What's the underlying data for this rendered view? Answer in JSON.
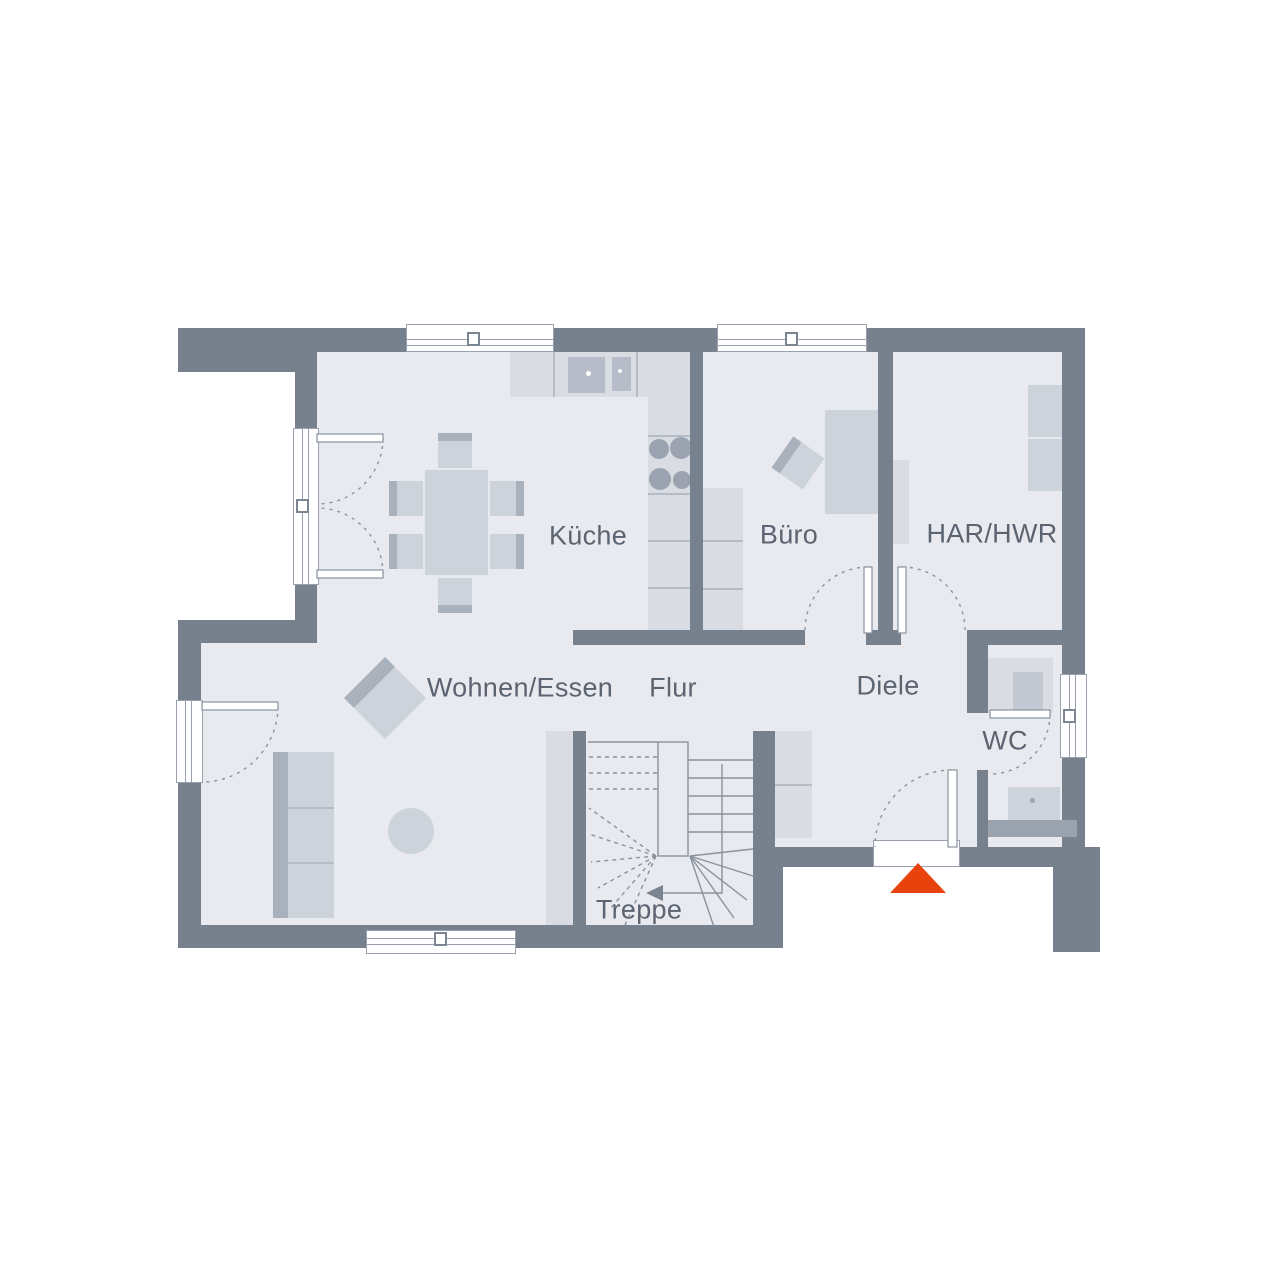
{
  "plan": {
    "type": "floor-plan",
    "language": "de",
    "rooms": [
      {
        "id": "kueche",
        "label": "Küche"
      },
      {
        "id": "buero",
        "label": "Büro"
      },
      {
        "id": "har_hwr",
        "label": "HAR/HWR"
      },
      {
        "id": "wohnen_essen",
        "label": "Wohnen/Essen"
      },
      {
        "id": "flur",
        "label": "Flur"
      },
      {
        "id": "diele",
        "label": "Diele"
      },
      {
        "id": "wc",
        "label": "WC"
      },
      {
        "id": "treppe",
        "label": "Treppe"
      }
    ],
    "markers": {
      "entrance": {
        "icon": "triangle-up",
        "color": "#E8430D"
      }
    },
    "colors": {
      "background": "#FFFFFF",
      "wall": "#77818E",
      "floor": "#E8EAEF",
      "furniture": "#CDD3DB",
      "furniture_light": "#D9DDE3",
      "furniture_dark": "#A9B1BD",
      "line": "#8A939F",
      "label_text": "#5C6471",
      "entrance_marker": "#E8430D"
    }
  }
}
